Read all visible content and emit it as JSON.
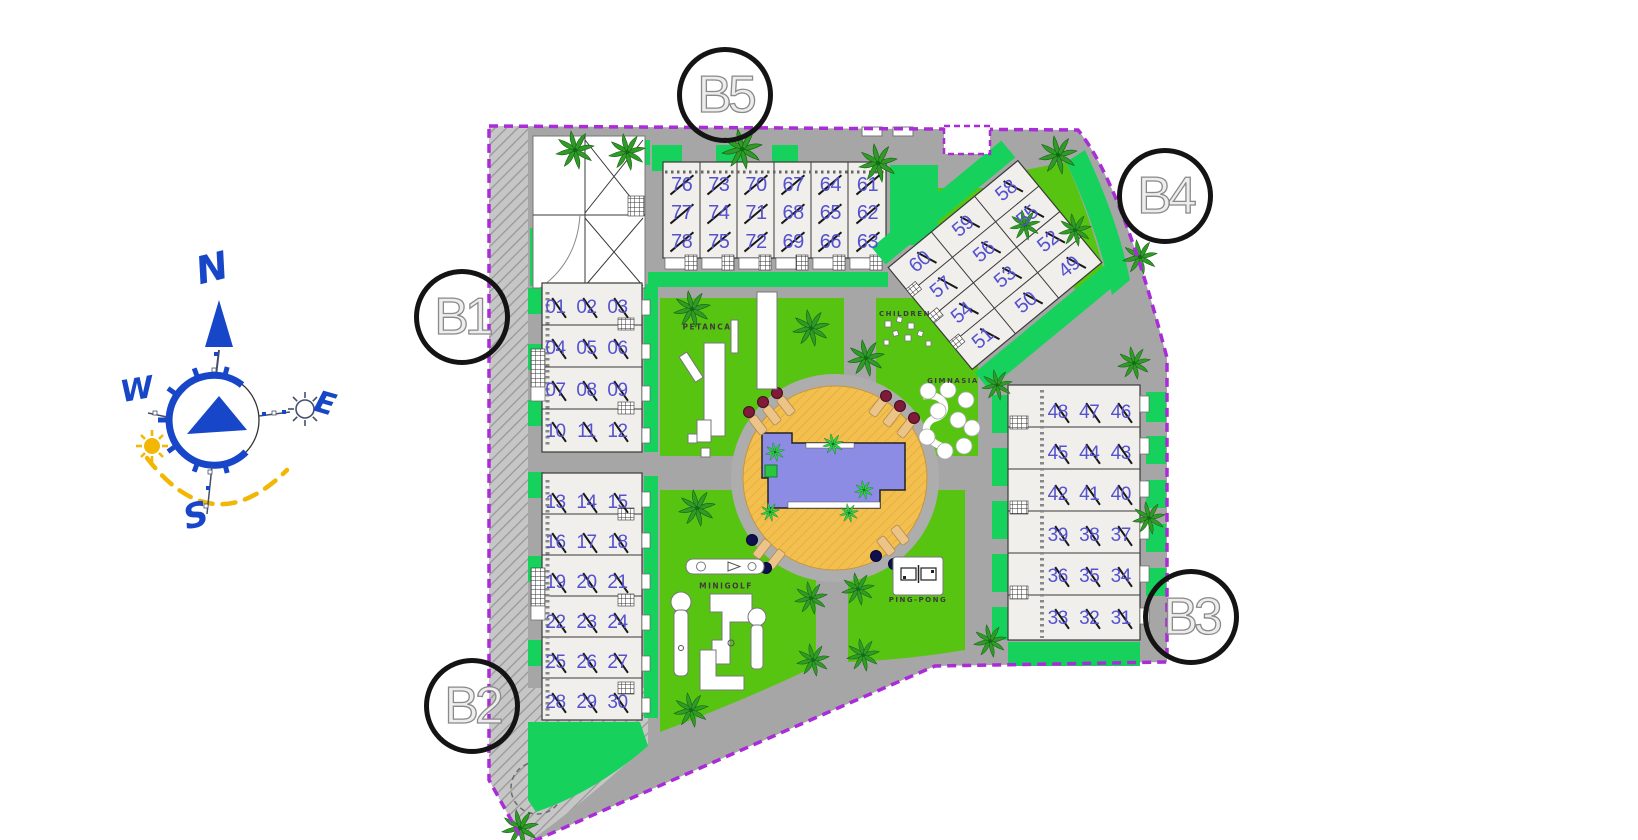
{
  "blocks": [
    {
      "id": "b1",
      "label": "B1"
    },
    {
      "id": "b2",
      "label": "B2"
    },
    {
      "id": "b3",
      "label": "B3"
    },
    {
      "id": "b4",
      "label": "B4"
    },
    {
      "id": "b5",
      "label": "B5"
    }
  ],
  "units": {
    "b5_rows": [
      [
        "76",
        "73",
        "70",
        "67",
        "64",
        "61"
      ],
      [
        "77",
        "74",
        "71",
        "68",
        "65",
        "62"
      ],
      [
        "78",
        "75",
        "72",
        "69",
        "66",
        "63"
      ]
    ],
    "b4_rows": [
      [
        "60",
        "59",
        "58"
      ],
      [
        "57",
        "56",
        "55"
      ],
      [
        "54",
        "53",
        "52"
      ],
      [
        "51",
        "50",
        "49"
      ]
    ],
    "b1_rows": [
      [
        "01",
        "02",
        "03"
      ],
      [
        "04",
        "05",
        "06"
      ],
      [
        "07",
        "08",
        "09"
      ],
      [
        "10",
        "11",
        "12"
      ]
    ],
    "b2_rows": [
      [
        "13",
        "14",
        "15"
      ],
      [
        "16",
        "17",
        "18"
      ],
      [
        "19",
        "20",
        "21"
      ],
      [
        "22",
        "23",
        "24"
      ],
      [
        "25",
        "26",
        "27"
      ],
      [
        "28",
        "29",
        "30"
      ]
    ],
    "b3_rows": [
      [
        "48",
        "47",
        "46"
      ],
      [
        "45",
        "44",
        "43"
      ],
      [
        "42",
        "41",
        "40"
      ],
      [
        "39",
        "38",
        "37"
      ],
      [
        "36",
        "35",
        "34"
      ],
      [
        "33",
        "32",
        "31"
      ]
    ]
  },
  "amenities": {
    "petanca": "PETANCA",
    "children": "CHILDREN",
    "gimnasia": "GIMNASIA",
    "minigolf": "MINIGOLF",
    "ping_pong": "PING-PONG"
  },
  "compass": {
    "north": "N",
    "west": "W",
    "east": "E",
    "south": "S"
  },
  "colors": {
    "boundary": "#aa2cd8",
    "road": "#a6a6a6",
    "lawn": "#58c412",
    "garden": "#16d25c",
    "building": "#f1efeb",
    "pool": "#8c8ce4",
    "deck": "#f2bf4f",
    "unit": "#5552cf",
    "compass": "#1747c8",
    "sun": "#f2b705"
  }
}
